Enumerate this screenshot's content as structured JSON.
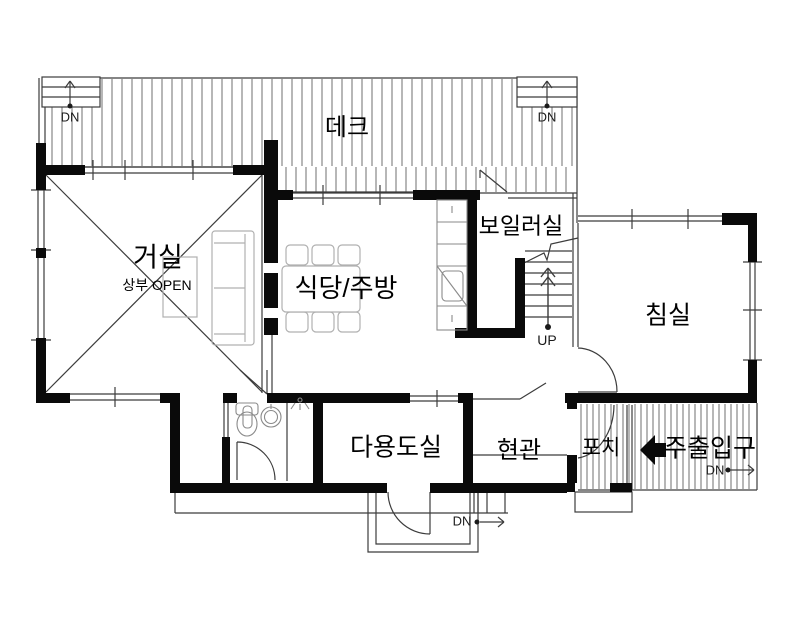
{
  "title": "주택 1층 평면도",
  "labels": {
    "deck": "데크",
    "living": "거실",
    "living_sub": "상부 OPEN",
    "dining": "식당/주방",
    "boiler": "보일러실",
    "bedroom": "침실",
    "utility": "다용도실",
    "entrance": "현관",
    "porch": "포치",
    "main_entry": "주출입구",
    "up": "UP",
    "dn": "DN"
  },
  "colors": {
    "wall": "#0a0a0a",
    "line": "#3c3c3c",
    "hatch": "#6f6f6f",
    "furniture": "#b0b0b0",
    "fixture": "#8a8a8a",
    "white": "#ffffff"
  }
}
